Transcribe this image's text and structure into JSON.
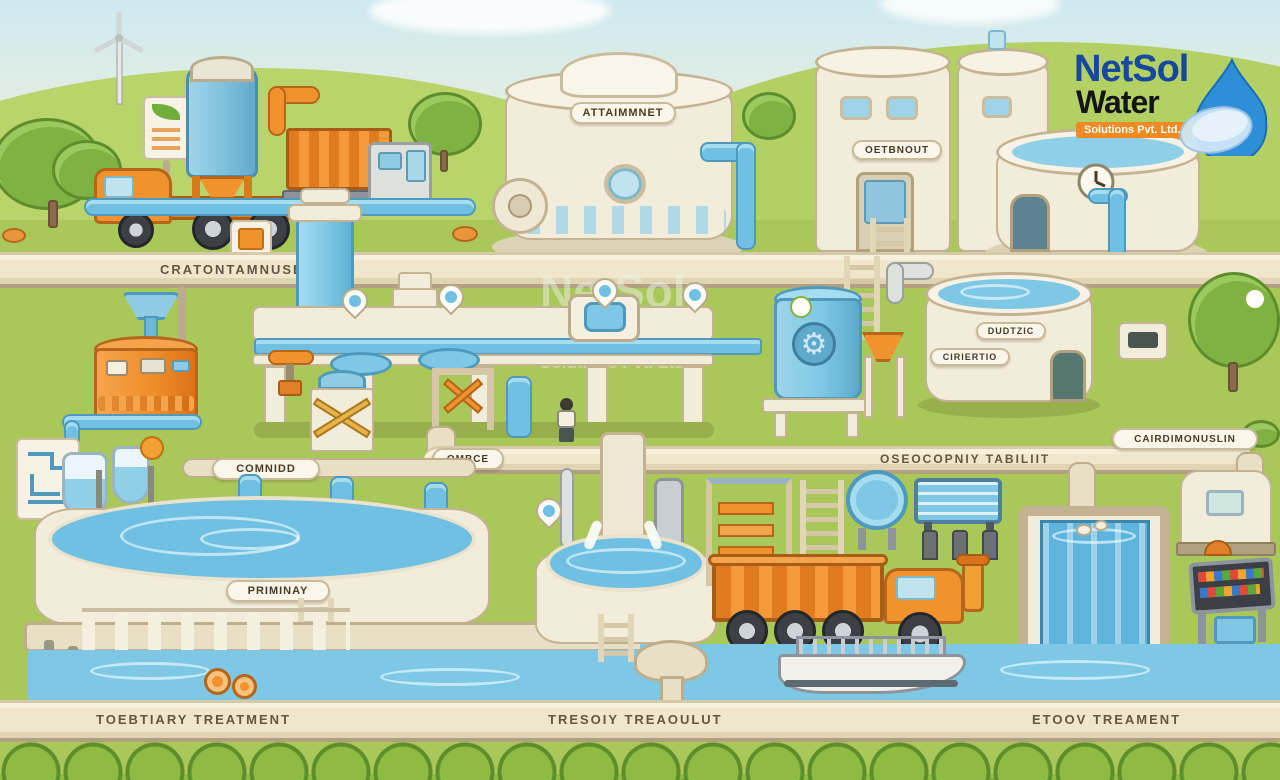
{
  "meta": {
    "title": "Cartoon wastewater treatment plant illustration"
  },
  "logo": {
    "name": "NetSol",
    "water": "Water",
    "tagline": "Solutions Pvt. Ltd."
  },
  "watermark": {
    "name": "NetSol",
    "water": "Water",
    "tagline": "Solutions Pvt. Ltd."
  },
  "labels": {
    "top_center_tank": "ATTAIMMNET",
    "top_right_tank": "OETBNOUT",
    "top_band": "CRATONTAMNUSEOOV",
    "mid_right_tank_upper": "DUDTZIC",
    "mid_right_tank_lower": "CIRIERTIO",
    "right_band": "OSEOCOPNIY TABILIIT",
    "right_sign": "CAIRDIMONUSLIN",
    "clarifier_pipe_sign": "COMNIDD",
    "pipe_elbow_sign": "OMBCE",
    "primary_clarifier": "PRIMINAY",
    "bottom_right_tank": "TROMZTAOCIOTIIN",
    "bottom_band_left": "TOEBTIARY TREATMENT",
    "bottom_band_center": "TRESOIY TREAOULUT",
    "bottom_band_right": "ETOOV TREAMENT"
  },
  "colors": {
    "sky": "#cde9ef",
    "grass": "#aac75a",
    "band": "#efe6cb",
    "cream": "#f2ecdb",
    "water_blue": "#7ec8e6",
    "accent_orange": "#f0922e",
    "logo_blue": "#1a5fa8",
    "logo_orange": "#f18a21",
    "label_brown": "#4a3b26",
    "bush_green": "#8fbb45"
  }
}
